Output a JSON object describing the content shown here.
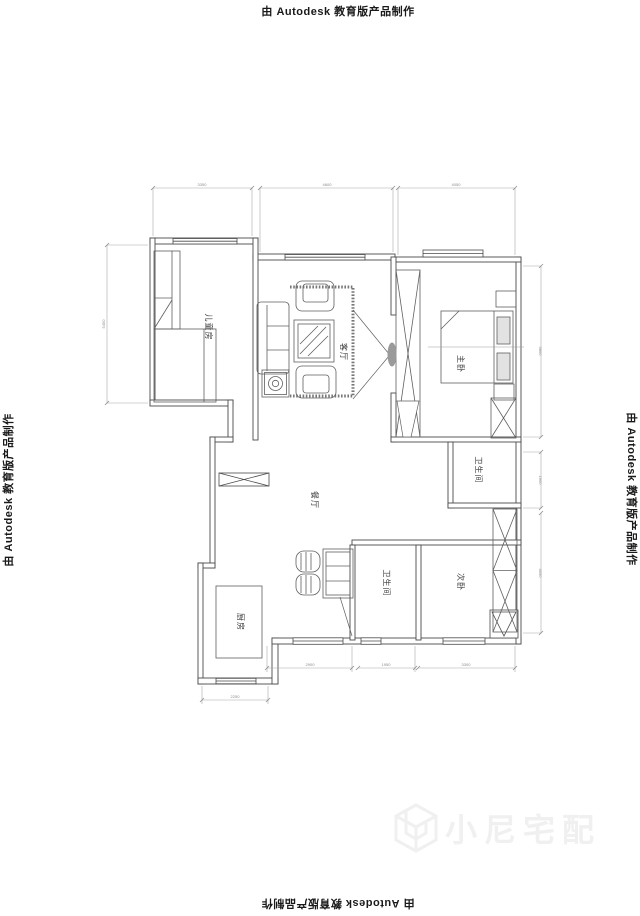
{
  "watermark": {
    "text": "由 Autodesk 教育版产品制作"
  },
  "brand": {
    "text": "小尼宅配"
  },
  "rooms": {
    "children": "儿童房",
    "living": "客厅",
    "master": "主卧",
    "bath_upper": "卫生间",
    "dining": "餐厅",
    "bath_lower": "卫生间",
    "second": "次卧",
    "kitchen": "厨房"
  },
  "dims": {
    "top": [
      "3350",
      "4600",
      "4050"
    ],
    "left": [
      "5450"
    ],
    "right": [
      "5800",
      "1900",
      "4050"
    ],
    "bottom": [
      "2900",
      "1950",
      "3300"
    ],
    "bottom2": [
      "2250"
    ]
  },
  "colors": {
    "wall": "#4a4a4a",
    "furniture": "#5f5f5f",
    "dim": "#9b9b9b",
    "label": "#3c3c3c",
    "brand": "#f0f0f0"
  }
}
